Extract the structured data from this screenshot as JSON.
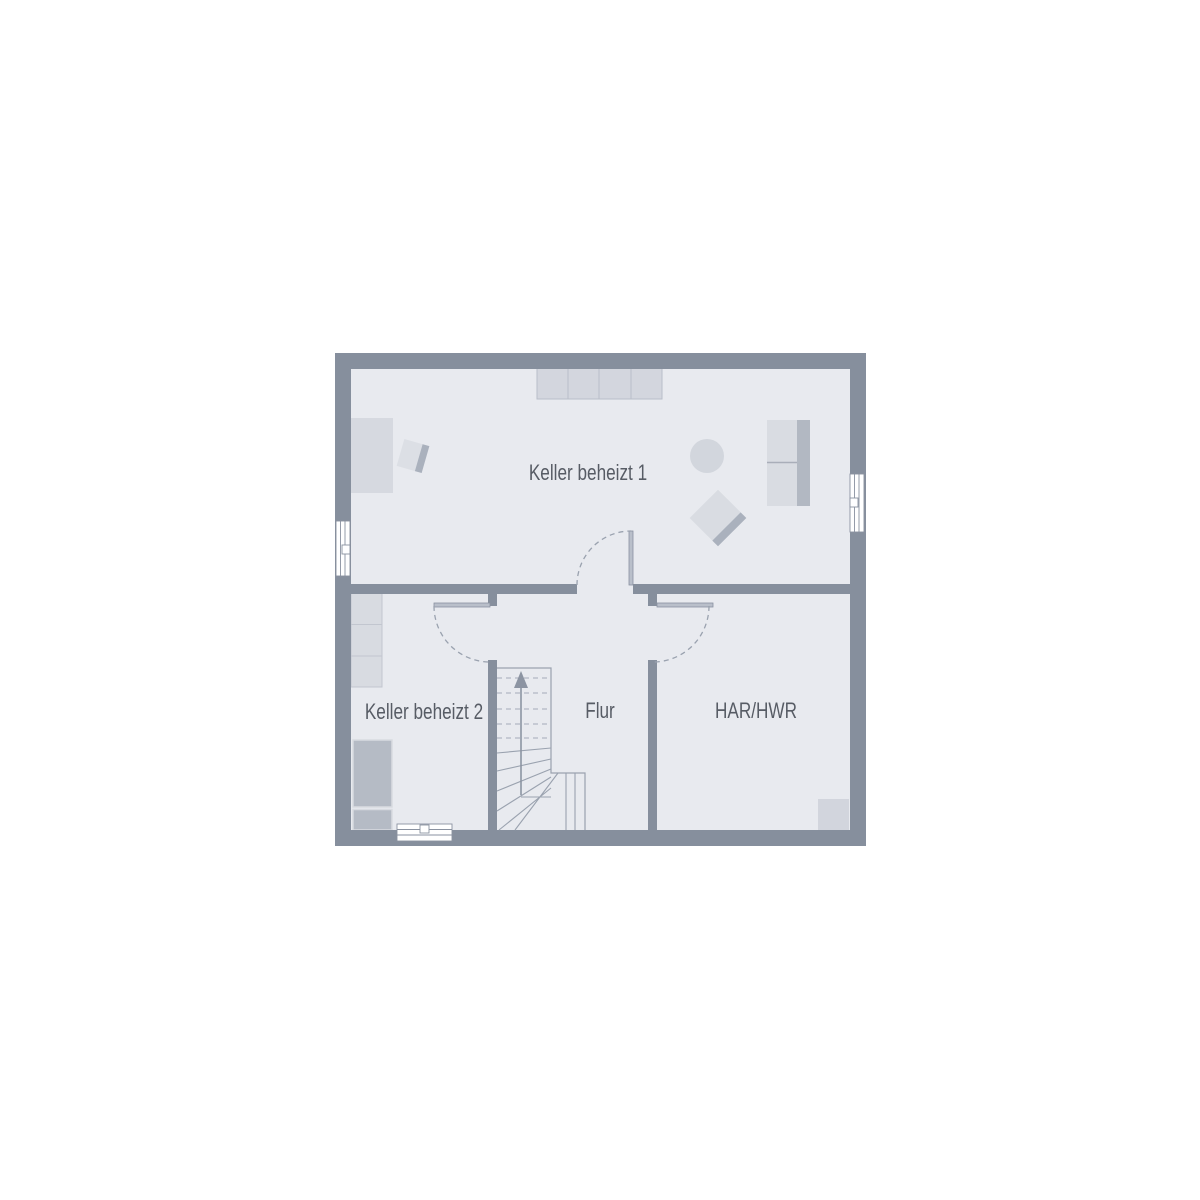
{
  "plan": {
    "rooms": [
      {
        "id": "keller-beheizt-1",
        "label": "Keller beheizt 1"
      },
      {
        "id": "keller-beheizt-2",
        "label": "Keller beheizt 2"
      },
      {
        "id": "flur",
        "label": "Flur"
      },
      {
        "id": "har-hwr",
        "label": "HAR/HWR"
      }
    ],
    "stairs": {
      "direction_icon": "up-arrow"
    },
    "colors": {
      "background": "#ffffff",
      "wall": "#868f9d",
      "floor": "#e8eaef",
      "furniture_light": "#d6d9e0",
      "furniture_mid": "#d3d6de",
      "furniture_accent": "#aab1bd",
      "furniture_bed": "#b5bbc5",
      "outline": "#c2c6cf",
      "line": "#9aa2af",
      "dash": "#a4abb8",
      "arrow": "#8c94a2",
      "window": "#ffffff",
      "window_stroke": "#8a92a0",
      "text": "#575c65"
    }
  }
}
